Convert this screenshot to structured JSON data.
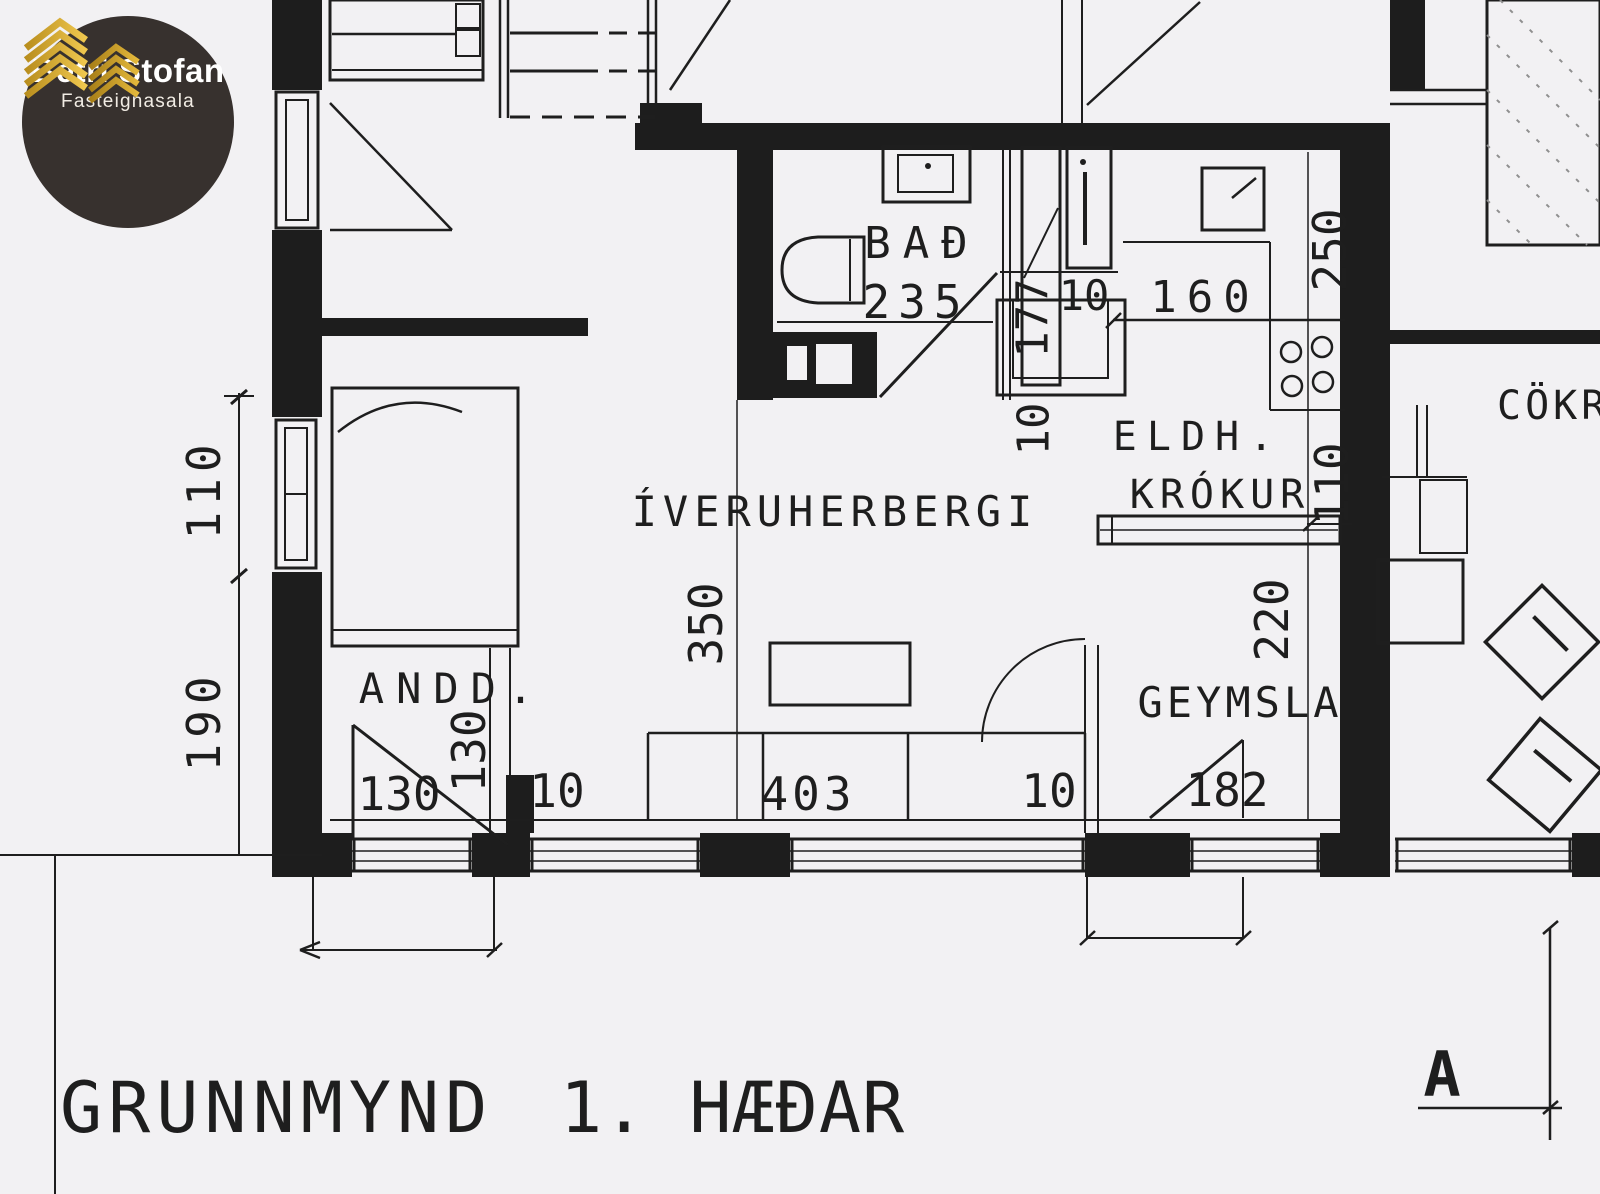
{
  "logo": {
    "title": "Betri Stofan",
    "subtitle": "Fasteignasala",
    "icon": "stacked-gold-roofs-icon",
    "colors": {
      "circle": "#37312e",
      "gold": "#d9a82a",
      "text": "#ffffff"
    }
  },
  "plan": {
    "caption": {
      "main": "GRUNNMYND",
      "floor": "1. HÆÐAR"
    },
    "section_marker": "A",
    "rooms": {
      "bathroom": {
        "label": "BAÐ",
        "dim": "235"
      },
      "living": {
        "label": "ÍVERUHERBERGI",
        "height_dim": "350"
      },
      "kitchen_nook": {
        "label_line1": "ELDH.",
        "label_line2": "KRÓKUR",
        "width_dim": "160"
      },
      "storage": {
        "label": "GEYMSLA",
        "width_dim": "182"
      },
      "entry": {
        "label": "ANDD.",
        "width_dim": "130",
        "depth_dim": "130"
      },
      "right_partial_label": "CÖKR"
    },
    "dimensions": {
      "left_upper": "110",
      "left_lower": "190",
      "entry_gap": "10",
      "sofa_width": "403",
      "living_gap": "10",
      "closet_gap_top": "10",
      "closet_depth": "177",
      "closet_gap_bottom": "10",
      "kitchen_right_top": "250",
      "kitchen_right_mid": "110",
      "kitchen_right_bottom": "220"
    },
    "colors": {
      "paper": "#f2f1f3",
      "ink": "#1e1e1e"
    }
  }
}
